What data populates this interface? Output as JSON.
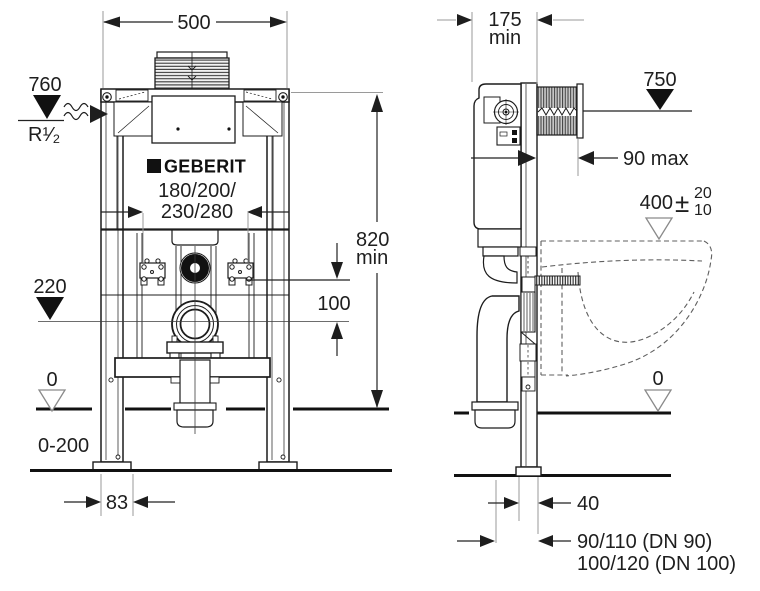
{
  "meta": {
    "ink_color": "#1c1c1c",
    "dim_color": "#222222",
    "gray_color": "#999999",
    "background": "#ffffff"
  },
  "brand": {
    "logo_text": "GEBERIT"
  },
  "front_view": {
    "width": "500",
    "supply_height": "760",
    "supply_thread": "R¹⁄₂",
    "model_heights_line1": "180/200/",
    "model_heights_line2": "230/280",
    "frame_height": "820",
    "frame_height_unit": "min",
    "outlet_height": "220",
    "outlet_drop": "100",
    "floor_level": "0",
    "floor_buildup": "0-200",
    "leg_offset": "83"
  },
  "side_view": {
    "depth": "175",
    "depth_unit": "min",
    "flush_pipe_height": "750",
    "protrusion": "90 max",
    "wc_height": "400",
    "wc_tolerance_sign": "±",
    "wc_tolerance_plus": "20",
    "wc_tolerance_minus": "10",
    "floor_level": "0",
    "wall_offset": "40",
    "drain_line1": "90/110 (DN 90)",
    "drain_line2": "100/120 (DN 100)"
  }
}
